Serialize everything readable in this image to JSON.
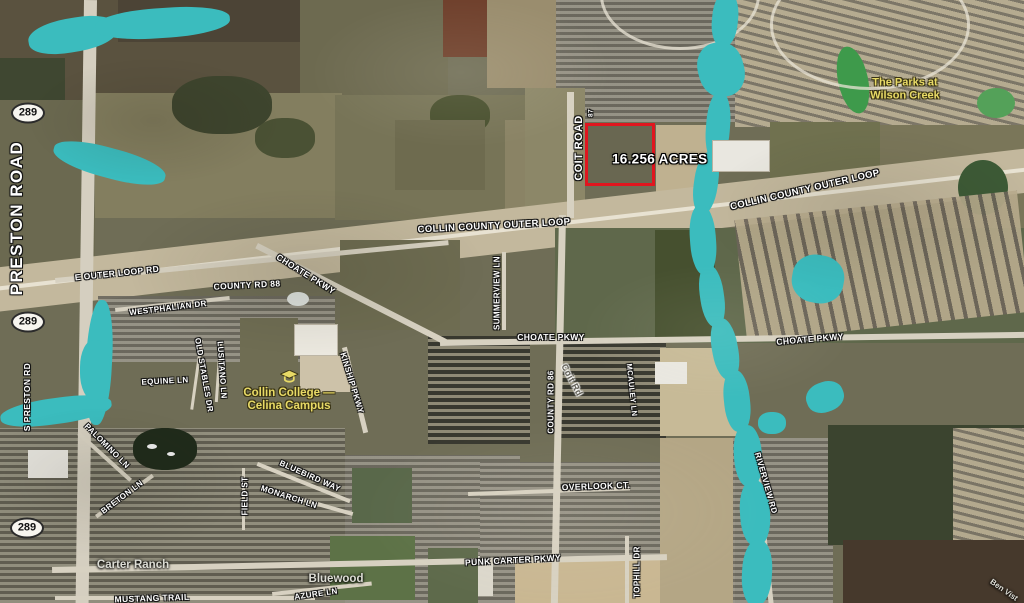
{
  "map": {
    "type": "satellite-aerial",
    "colors": {
      "creek": "#3bbcbe",
      "pond_green": "#3e9a4b",
      "parcel_outline": "#e0161f",
      "road_label": "#ffffff",
      "place_label": "#dcdcd4",
      "poi_label": "#e8da66"
    },
    "parcel": {
      "acres_label": "16.256 ACRES",
      "x": 585,
      "y": 123,
      "width": 70,
      "height": 63,
      "label_x": 612,
      "label_y": 159
    },
    "highway_shields": [
      {
        "label": "289",
        "x": 28,
        "y": 113
      },
      {
        "label": "289",
        "x": 28,
        "y": 322
      },
      {
        "label": "289",
        "x": 27,
        "y": 528
      }
    ],
    "road_labels": [
      {
        "text": "PRESTON ROAD",
        "x": 17,
        "y": 218,
        "rot": -90,
        "size": 17,
        "ls": 1.5
      },
      {
        "text": "S PRESTON RD",
        "x": 27,
        "y": 397,
        "rot": -90,
        "size": 8.5
      },
      {
        "text": "COIT ROAD",
        "x": 579,
        "y": 148,
        "rot": -90,
        "size": 11
      },
      {
        "text": "87",
        "x": 591,
        "y": 113,
        "rot": -90,
        "size": 6.5
      },
      {
        "text": "COLLIN COUNTY OUTER LOOP",
        "x": 494,
        "y": 226,
        "rot": -3,
        "size": 9.5
      },
      {
        "text": "COLLIN COUNTY OUTER LOOP",
        "x": 805,
        "y": 190,
        "rot": -13,
        "size": 9.5
      },
      {
        "text": "E OUTER LOOP RD",
        "x": 117,
        "y": 273,
        "rot": -6,
        "size": 8.5
      },
      {
        "text": "COUNTY RD 88",
        "x": 247,
        "y": 285,
        "rot": -3,
        "size": 8.5
      },
      {
        "text": "CHOATE PKWY",
        "x": 306,
        "y": 274,
        "rot": 32,
        "size": 8.5
      },
      {
        "text": "WESTPHALIAN DR",
        "x": 168,
        "y": 308,
        "rot": -7,
        "size": 8
      },
      {
        "text": "SUMMERVIEW LN",
        "x": 497,
        "y": 293,
        "rot": -90,
        "size": 8
      },
      {
        "text": "CHOATE PKWY",
        "x": 551,
        "y": 337,
        "rot": 0,
        "size": 8.5
      },
      {
        "text": "COUNTY RD 86",
        "x": 551,
        "y": 402,
        "rot": -90,
        "size": 8
      },
      {
        "text": "Coit Rd",
        "x": 572,
        "y": 380,
        "rot": 62,
        "size": 9,
        "style": "gray"
      },
      {
        "text": "CHOATE PKWY",
        "x": 810,
        "y": 339,
        "rot": -5,
        "size": 8.5
      },
      {
        "text": "MCAULEY LN",
        "x": 632,
        "y": 390,
        "rot": 84,
        "size": 7.5
      },
      {
        "text": "EQUINE LN",
        "x": 165,
        "y": 381,
        "rot": -3,
        "size": 8
      },
      {
        "text": "OLD STABLES DR",
        "x": 204,
        "y": 375,
        "rot": 80,
        "size": 8
      },
      {
        "text": "LUSITANO LN",
        "x": 222,
        "y": 370,
        "rot": 86,
        "size": 8
      },
      {
        "text": "KINSHIP PKWY",
        "x": 352,
        "y": 383,
        "rot": 73,
        "size": 8
      },
      {
        "text": "PALOMINO LN",
        "x": 107,
        "y": 446,
        "rot": 45,
        "size": 8
      },
      {
        "text": "BRETON LN",
        "x": 122,
        "y": 497,
        "rot": -37,
        "size": 8
      },
      {
        "text": "BLUEBIRD WAY",
        "x": 310,
        "y": 476,
        "rot": 24,
        "size": 8
      },
      {
        "text": "MONARCH LN",
        "x": 289,
        "y": 497,
        "rot": 18,
        "size": 8
      },
      {
        "text": "FIELD ST",
        "x": 245,
        "y": 496,
        "rot": -90,
        "size": 8
      },
      {
        "text": "OVERLOOK CT.",
        "x": 596,
        "y": 486,
        "rot": -2,
        "size": 8.5
      },
      {
        "text": "PUNK CARTER PKWY",
        "x": 513,
        "y": 560,
        "rot": -3,
        "size": 8.5
      },
      {
        "text": "TOPHILL DR",
        "x": 637,
        "y": 572,
        "rot": -90,
        "size": 8
      },
      {
        "text": "RIVERVIEW RD",
        "x": 766,
        "y": 483,
        "rot": 74,
        "size": 8
      },
      {
        "text": "MUSTANG TRAIL",
        "x": 152,
        "y": 598,
        "rot": -2,
        "size": 8.5
      },
      {
        "text": "AZURE LN",
        "x": 316,
        "y": 594,
        "rot": -8,
        "size": 8
      }
    ],
    "place_labels": [
      {
        "text": "Carter Ranch",
        "x": 133,
        "y": 565,
        "rot": 0,
        "size": 11.5
      },
      {
        "text": "Bluewood",
        "x": 336,
        "y": 579,
        "rot": 0,
        "size": 11.5
      },
      {
        "text": "Ben Vist",
        "x": 1004,
        "y": 590,
        "rot": 35,
        "size": 8
      }
    ],
    "poi_labels": [
      {
        "lines": [
          "The Parks at",
          "Wilson Creek"
        ],
        "x": 905,
        "y": 89,
        "size": 11,
        "icon": null
      },
      {
        "lines": [
          "Collin College —",
          "Celina Campus"
        ],
        "x": 289,
        "y": 392,
        "size": 11.5,
        "icon": "graduation-cap"
      }
    ]
  }
}
